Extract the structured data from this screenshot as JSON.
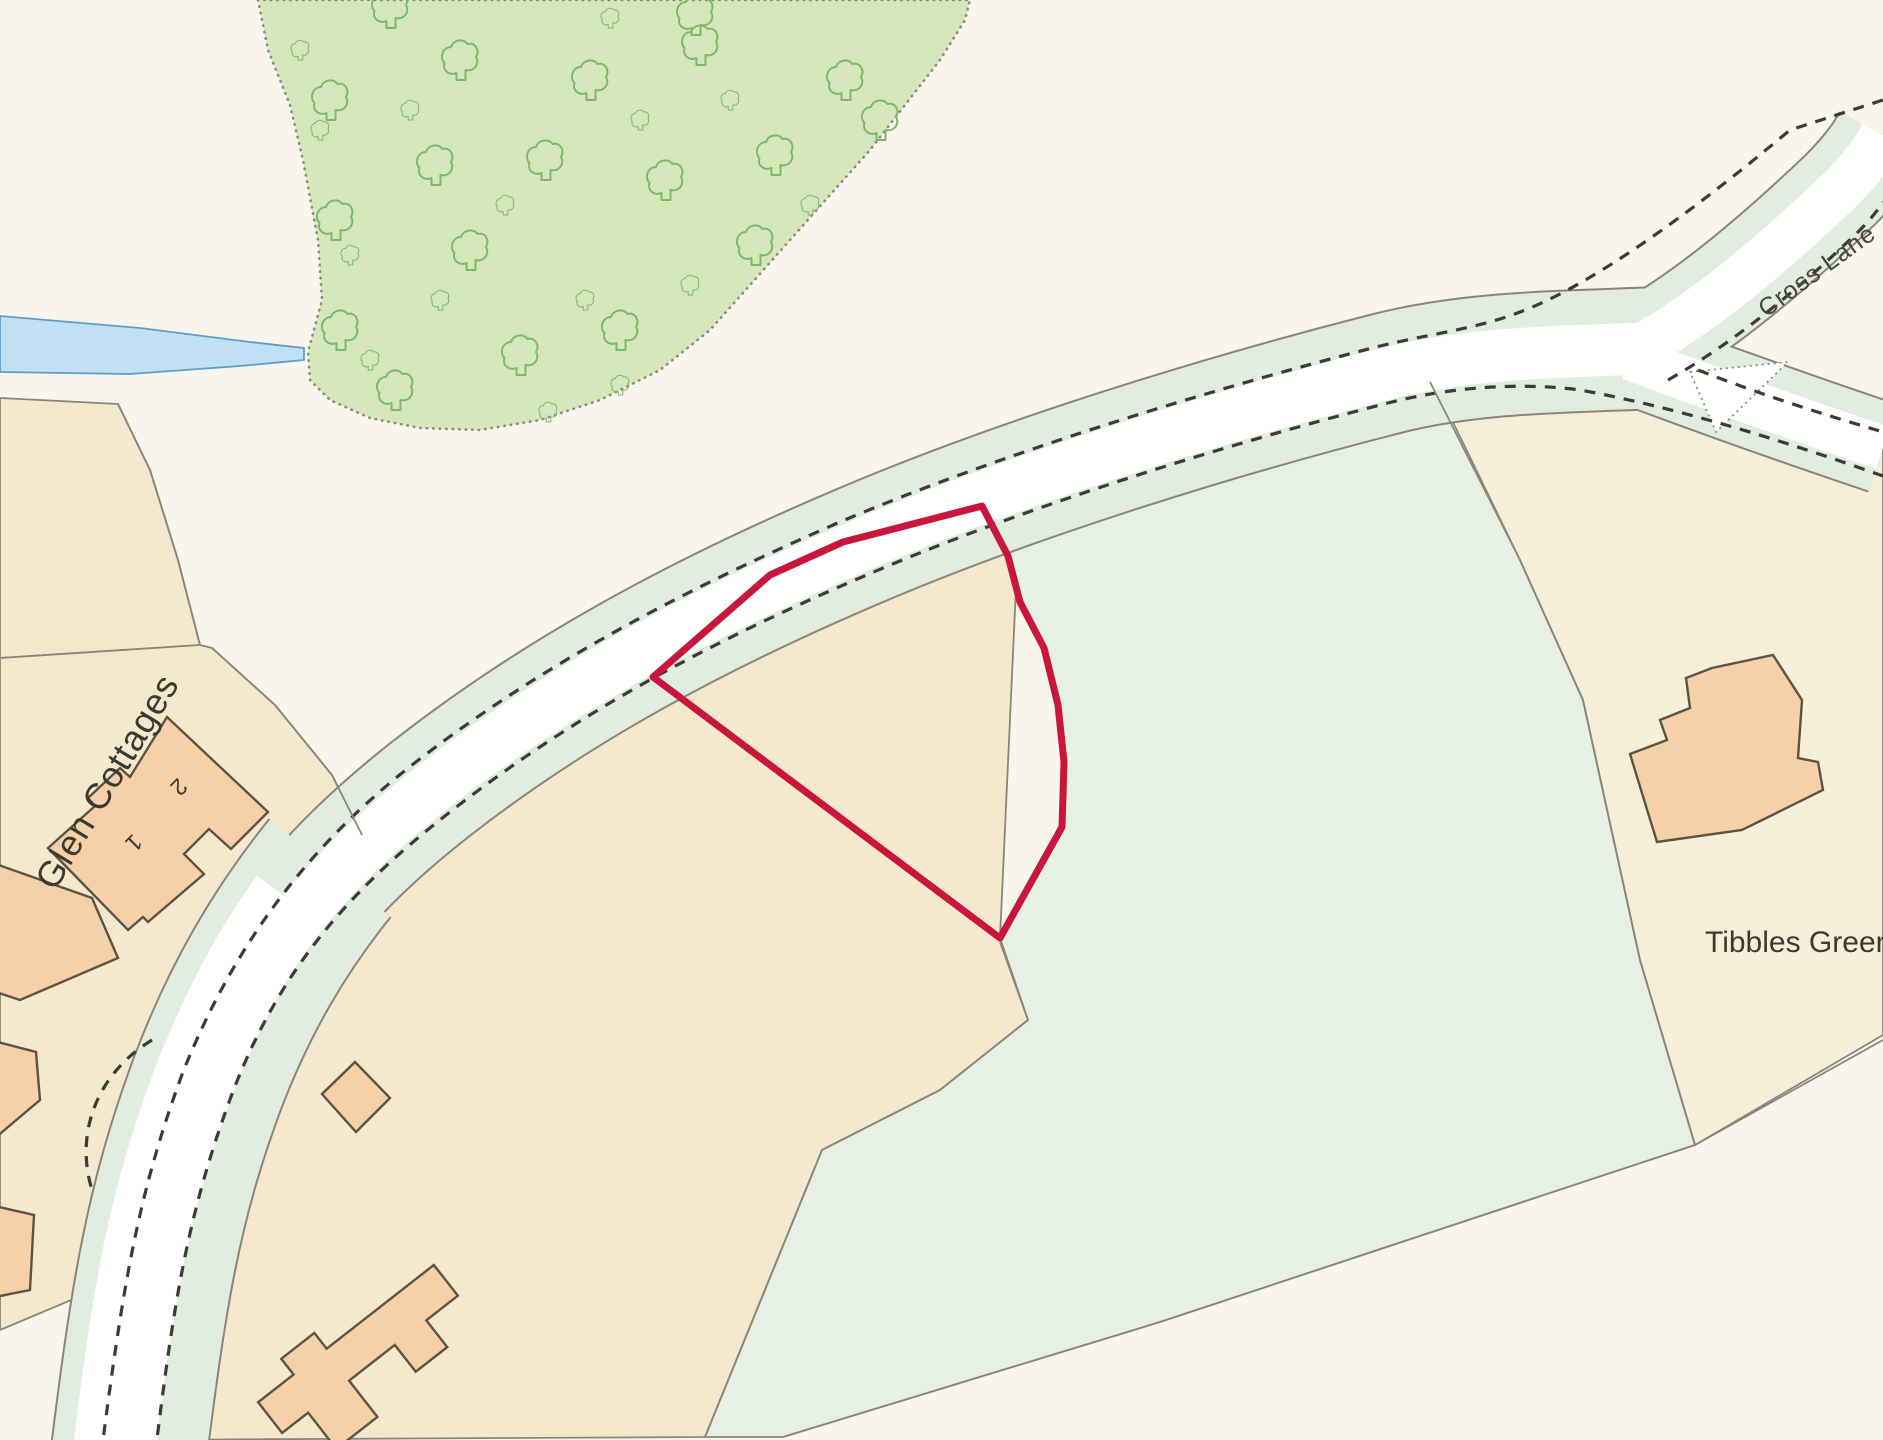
{
  "labels": {
    "road_name": "Cross Lane",
    "settlement": "Glen Cottages",
    "area_name": "Tibbles Green",
    "cottage_number_1": "1",
    "cottage_number_2": "2"
  },
  "colors": {
    "background": "#f8f5ec",
    "field_cream": "#f5e9cd",
    "field_cream_light": "#f7eed8",
    "field_green": "#e7f0e4",
    "verge": "#e1ede0",
    "road_white": "#ffffff",
    "woodland": "#d4e8bc",
    "tree": "#7cb96a",
    "woodland_edge": "#8a8d7a",
    "stream_fill": "#c2e1f5",
    "stream_edge": "#5f9ec9",
    "building_fill": "#f6d0a6",
    "building_stroke": "#5c5345",
    "boundary": "#8b8679",
    "dash": "#3c3c36",
    "plot": "#c9163c",
    "text": "#3b3a31",
    "road_text": "#474740"
  }
}
